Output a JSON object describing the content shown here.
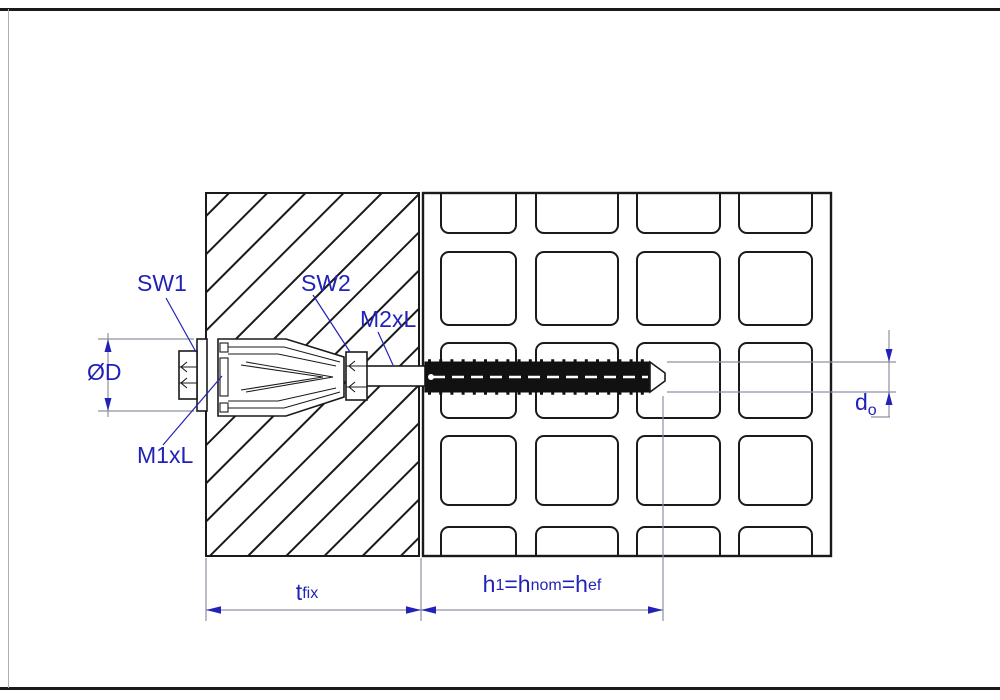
{
  "drawing": {
    "labels": {
      "sw1": "SW1",
      "sw2": "SW2",
      "m1xl": "M1xL",
      "m2xl": "M2xL",
      "diameter": "ØD",
      "tfix": {
        "main": "t",
        "sub": "fix"
      },
      "h": {
        "p1": "h",
        "s1": "1",
        "p2": "=h",
        "s2": "nom",
        "p3": "=h",
        "s3": "ef"
      },
      "do": {
        "main": "d",
        "sub": "o"
      }
    },
    "colors": {
      "annotation_blue": "#2222b8",
      "dimension_gray": "#9090a0",
      "line_black": "#1a1a1a",
      "background": "#ffffff"
    }
  }
}
